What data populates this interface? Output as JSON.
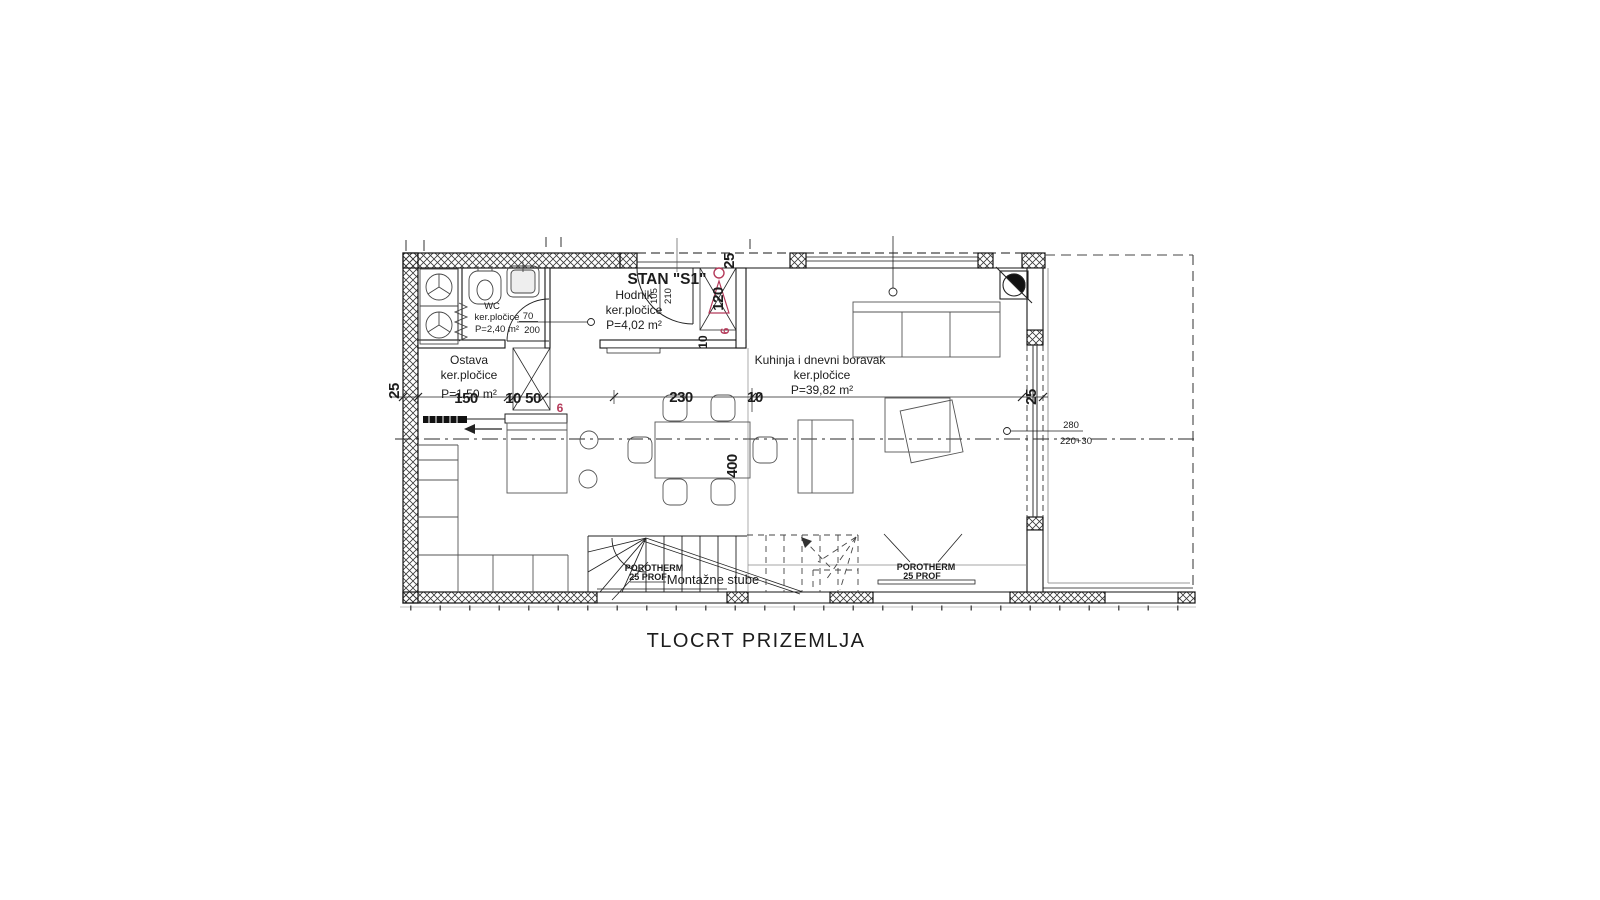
{
  "title": "TLOCRT PRIZEMLJA",
  "unit": {
    "label": "STAN \"S1\""
  },
  "rooms": {
    "hodnik": {
      "name": "Hodnik",
      "floor": "ker.pločice",
      "area": "P=4,02 m²"
    },
    "wc": {
      "name": "WC",
      "floor": "ker.pločice",
      "area": "P=2,40 m²",
      "door_w": "70",
      "door_h": "200"
    },
    "ostava": {
      "name": "Ostava",
      "floor": "ker.pločice",
      "area": "P=1,50 m²"
    },
    "kuhinja": {
      "name": "Kuhinja i dnevni boravak",
      "floor": "ker.pločice",
      "area": "P=39,82 m²"
    }
  },
  "stairs": {
    "label": "Montažne stube"
  },
  "wall_spec": {
    "line1": "POROTHERM",
    "line2": "25 PROF"
  },
  "dims": {
    "wall_left": "25",
    "ostava_w": "150",
    "d10a": "10",
    "d50": "50",
    "dining_w": "230",
    "d10b": "10",
    "wall_right": "25",
    "table_l": "400",
    "niche_top": "25",
    "niche_h": "120",
    "niche_b": "10",
    "red6a": "6",
    "red6b": "6",
    "door_entry_w": "105",
    "door_entry_h": "210",
    "window_right_w": "280",
    "window_right_sill": "220+30"
  },
  "colors": {
    "accent_red": "#b43a5a",
    "title_blue": "#2b4a8c"
  }
}
